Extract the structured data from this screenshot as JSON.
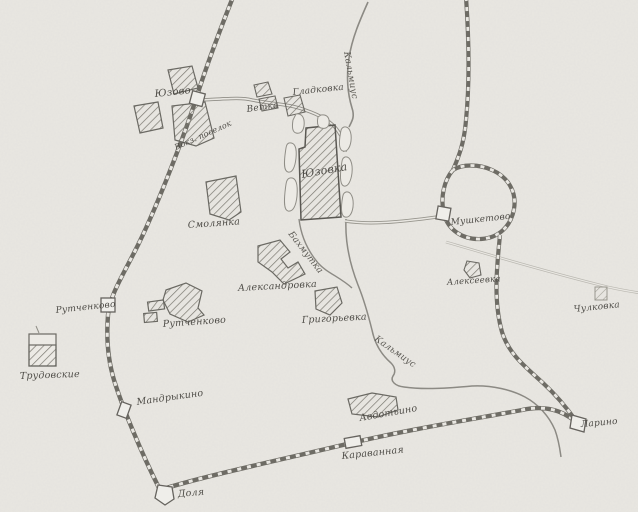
{
  "map": {
    "labels": {
      "yuzovo": "Юзово",
      "vokz_poselok": "Вокз. поселок",
      "vetka": "Ветка",
      "gladkovka": "Гладковка",
      "yuzovka": "Юзовка",
      "smolyanka": "Смолянка",
      "aleksandrovka": "Александровка",
      "grigoryevka": "Григорьевка",
      "rutchenkovo_station": "Рутченково",
      "rutchenkovo_village": "Рутченково",
      "trudovskie": "Трудовские",
      "mandrykino": "Мандрыкино",
      "dolya": "Доля",
      "karavannaya": "Караванная",
      "avdotino": "Авдотьино",
      "larino": "Ларино",
      "mushketovo": "Мушкетово",
      "alekseevka": "Алексеевка",
      "chulkovka": "Чулковка"
    },
    "rivers": {
      "kalmius_upper": "Кальмиус",
      "kalmius_lower": "Кальмиус",
      "bakhmutka": "Бахмутка"
    },
    "colors": {
      "paper": "#e9e7e2",
      "pencil": "#6f6d68",
      "pencil_dark": "#57554f",
      "pencil_light": "#a5a39c"
    }
  }
}
